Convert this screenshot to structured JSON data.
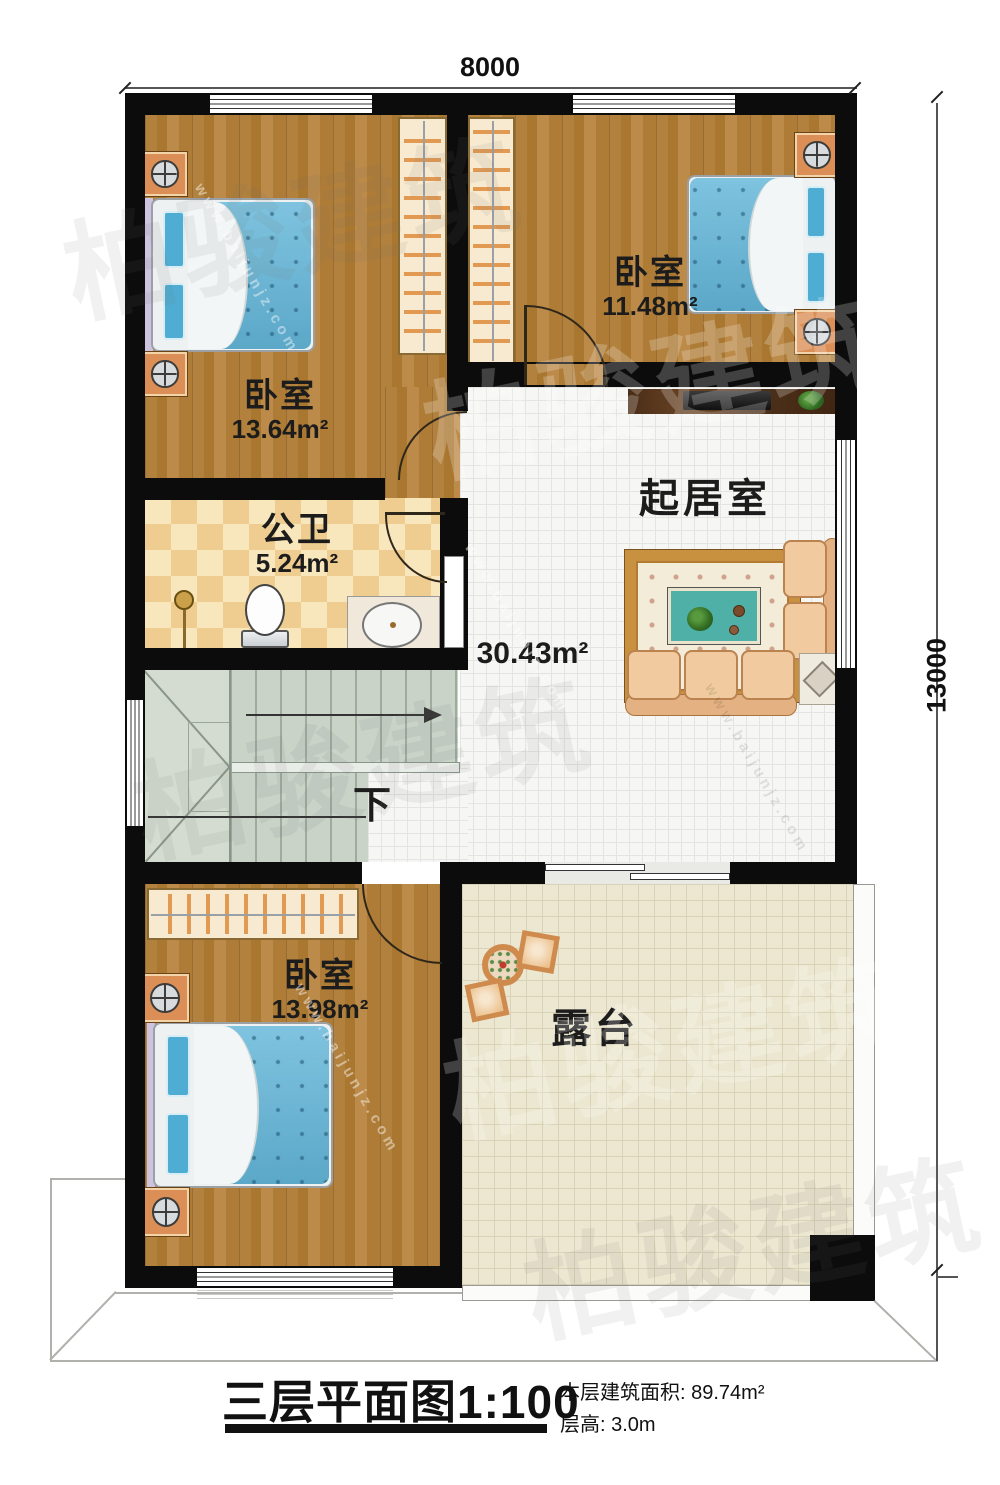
{
  "dimensions": {
    "width_mm": "8000",
    "height_mm": "13000"
  },
  "rooms": {
    "bedroom_top_left": {
      "name": "卧室",
      "area": "13.64m²"
    },
    "bedroom_top_right": {
      "name": "卧室",
      "area": "11.48m²"
    },
    "bathroom": {
      "name": "公卫",
      "area": "5.24m²"
    },
    "living_room": {
      "name": "起居室",
      "area": "30.43m²"
    },
    "bedroom_bottom": {
      "name": "卧室",
      "area": "13.98m²"
    },
    "terrace": {
      "name": "露台"
    }
  },
  "stairs": {
    "direction_label": "下"
  },
  "title_block": {
    "title": "三层平面图",
    "scale": "1:100",
    "area_label": "本层建筑面积:",
    "area_value": "89.74m²",
    "floor_height_label": "层高:",
    "floor_height_value": "3.0m"
  },
  "watermark": {
    "brand": "柏骏建筑",
    "site": "www.baijunjz.com"
  },
  "colors": {
    "wall": "#0c0c0c",
    "wood_floor": "#b1813e",
    "living_tile": "#f6f6f4",
    "terrace_tile": "#ece7d0",
    "bathroom_tile_a": "#efcd90",
    "bathroom_tile_b": "#f8e7bd",
    "stair": "#c9d3c8",
    "bed_blue": "#68b9da",
    "furniture_orange": "#db8e55",
    "sofa_tan": "#f1cb9f"
  }
}
